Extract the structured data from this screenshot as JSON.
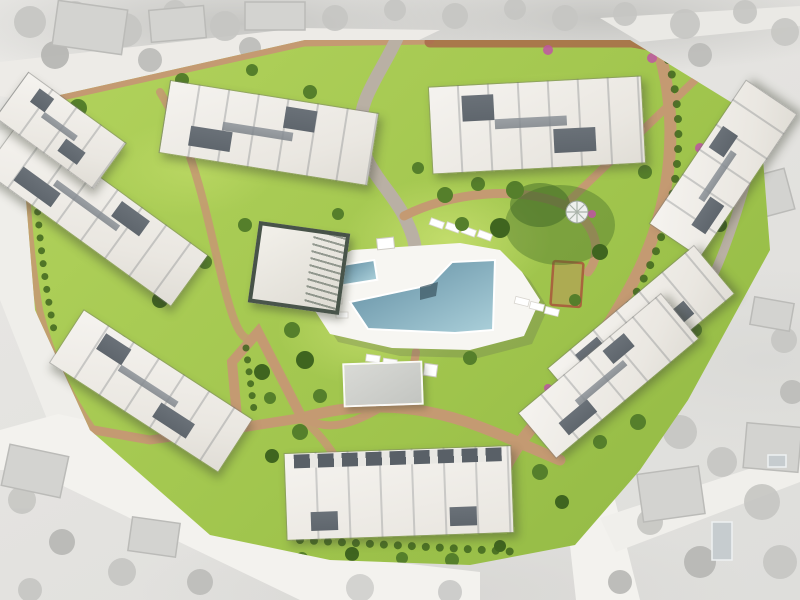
{
  "image": {
    "type": "architectural-aerial-rendering",
    "description": "Top-down master plan rendering of a gated residential apartment complex: eight white apartment blocks around landscaped gardens with a central free-form swimming pool, kids pool, clubhouse and winding paths; surrounding streets and villas shown in desaturated gray"
  },
  "palette": {
    "site_green": "#9fc44c",
    "lawn_light": "#b4d45e",
    "tree_green": "#557f2b",
    "shrub_dark": "#3f651f",
    "path_tan": "#c49a72",
    "path_red": "#a96a4a",
    "road_gray": "#b9b0a4",
    "building_white": "#f5f3ef",
    "roof_dark": "#6a7178",
    "deck_white": "#f7f6f2",
    "pool_blue": "#5f8ba0",
    "pool_blue_light": "#abd0da",
    "flower_pink": "#c055a5",
    "bg_gray": "#e6e5e2",
    "tree_gray": "#c6c6c3",
    "house_gray": "#d3d3d0",
    "road_white": "#f3f2ee"
  },
  "scene": {
    "site": {
      "label": "residential development site",
      "apartment_buildings": 8,
      "amenities": [
        "main swimming pool",
        "kids pool",
        "pool deck with sun loungers",
        "clubhouse with pergola",
        "garden gazebo",
        "central landscaped garden",
        "perimeter walking paths"
      ]
    },
    "surroundings": {
      "label": "existing neighborhood (grayscale aerial)",
      "features": [
        "access roads",
        "neighboring villas",
        "private pools",
        "tree cover"
      ]
    }
  }
}
